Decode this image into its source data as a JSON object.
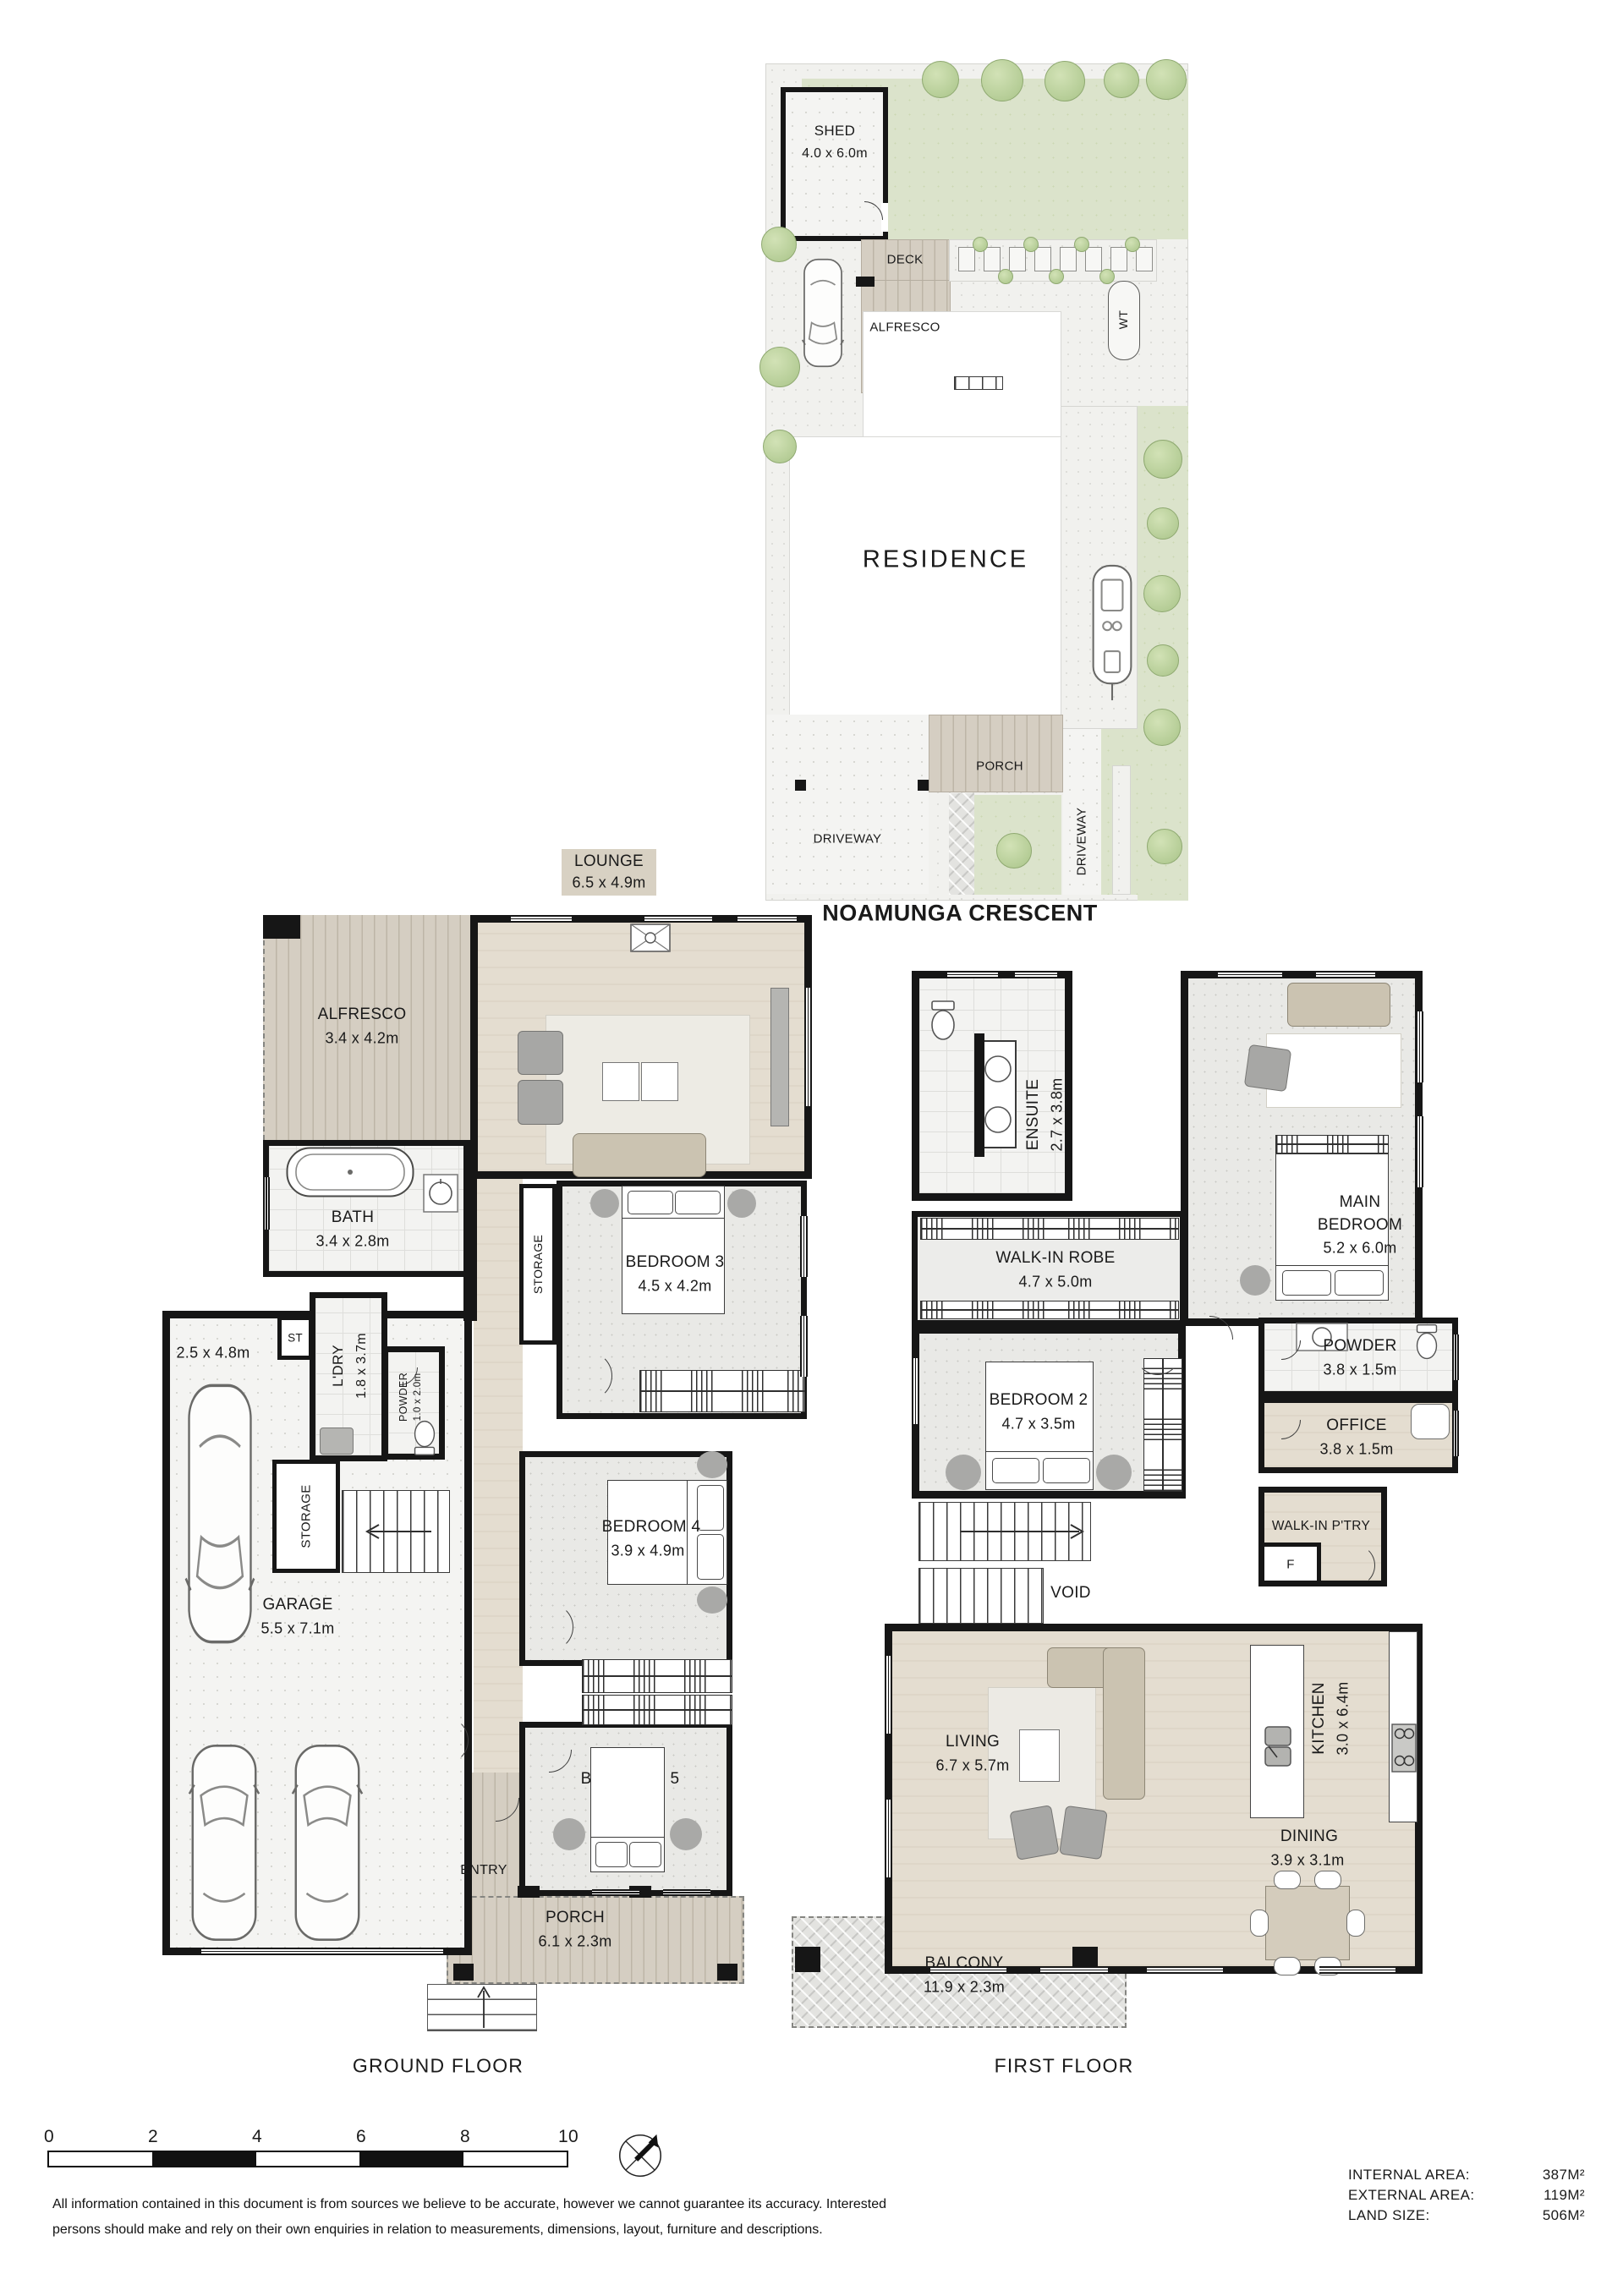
{
  "site": {
    "shed_name": "SHED",
    "shed_dims": "4.0 x 6.0m",
    "deck": "DECK",
    "alfresco": "ALFRESCO",
    "wt": "WT",
    "residence": "RESIDENCE",
    "porch": "PORCH",
    "driveway_front": "DRIVEWAY",
    "driveway_side": "DRIVEWAY",
    "street": "NOAMUNGA CRESCENT"
  },
  "ground_floor": {
    "title": "GROUND FLOOR",
    "lounge_name": "LOUNGE",
    "lounge_dims": "6.5 x 4.9m",
    "alfresco_name": "ALFRESCO",
    "alfresco_dims": "3.4 x 4.2m",
    "bath_name": "BATH",
    "bath_dims": "3.4 x 2.8m",
    "carspace_dims": "2.5 x 4.8m",
    "st": "ST",
    "ldry_name": "L'DRY",
    "ldry_dims": "1.8 x 3.7m",
    "powder_name": "POWDER",
    "powder_dims": "1.0 x 2.0m",
    "storage_hall": "STORAGE",
    "storage_garage": "STORAGE",
    "garage_name": "GARAGE",
    "garage_dims": "5.5 x 7.1m",
    "bed3_name": "BEDROOM 3",
    "bed3_dims": "4.5 x 4.2m",
    "bed4_name": "BEDROOM 4",
    "bed4_dims": "3.9 x 4.9m",
    "bed5_name": "BEDROOM 5",
    "entry": "ENTRY",
    "porch_name": "PORCH",
    "porch_dims": "6.1 x 2.3m"
  },
  "first_floor": {
    "title": "FIRST FLOOR",
    "ensuite_name": "ENSUITE",
    "ensuite_dims": "2.7 x 3.8m",
    "wir_name": "WALK-IN ROBE",
    "wir_dims": "4.7 x 5.0m",
    "main_line1": "MAIN",
    "main_line2": "BEDROOM",
    "main_dims": "5.2 x 6.0m",
    "powder_name": "POWDER",
    "powder_dims": "3.8 x 1.5m",
    "bed2_name": "BEDROOM 2",
    "bed2_dims": "4.7 x 3.5m",
    "office_name": "OFFICE",
    "office_dims": "3.8 x 1.5m",
    "pantry": "WALK-IN P'TRY",
    "fridge": "F",
    "void": "VOID",
    "living_name": "LIVING",
    "living_dims": "6.7 x 5.7m",
    "kitchen_name": "KITCHEN",
    "kitchen_dims": "3.0 x 6.4m",
    "dining_name": "DINING",
    "dining_dims": "3.9 x 3.1m",
    "balcony_name": "BALCONY",
    "balcony_dims": "11.9 x 2.3m"
  },
  "scale": {
    "t0": "0",
    "t1": "2",
    "t2": "4",
    "t3": "6",
    "t4": "8",
    "t5": "10"
  },
  "footer": {
    "disclaimer1": "All information contained in this document is from sources we believe to be accurate, however we cannot guarantee its accuracy. Interested",
    "disclaimer2": "persons should make and rely on their own enquiries in relation to measurements, dimensions, layout, furniture and descriptions.",
    "areas": [
      {
        "label": "INTERNAL AREA:",
        "value": "387M²"
      },
      {
        "label": "EXTERNAL AREA:",
        "value": "119M²"
      },
      {
        "label": "LAND SIZE:",
        "value": "506M²"
      }
    ]
  },
  "colors": {
    "wall": "#161616",
    "lawn": "#dbe3cb",
    "deck": "#d5cec2",
    "wood_floor": "#e4ddd0",
    "grey_floor": "#e9e9e6",
    "text": "#1a1a1a"
  }
}
